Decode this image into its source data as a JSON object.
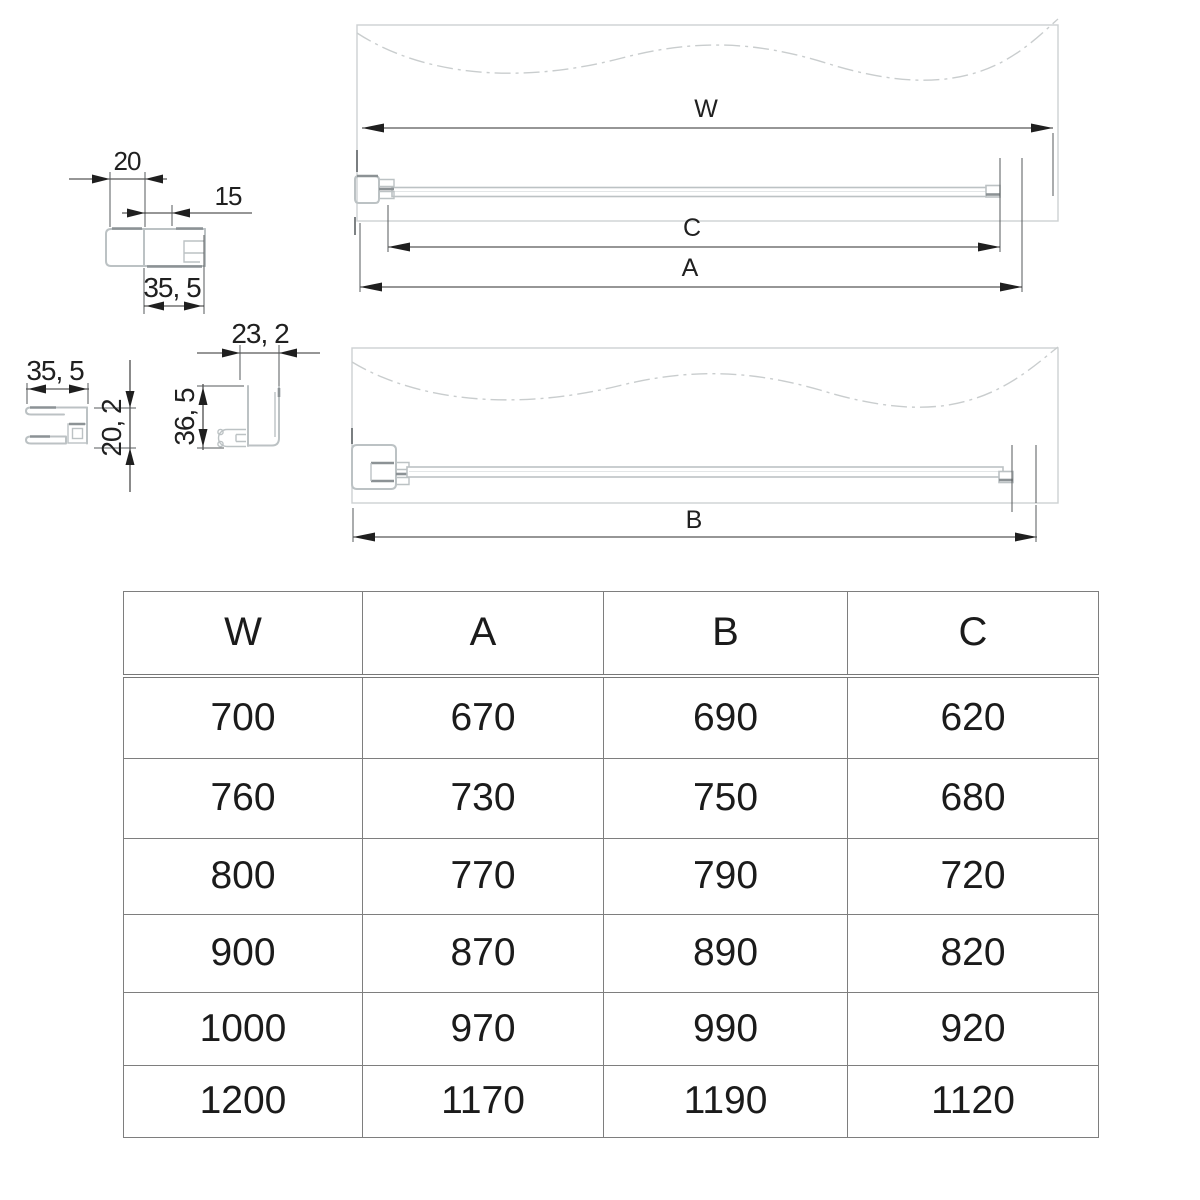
{
  "colors": {
    "profile_light": "#bcc2c4",
    "profile_dark": "#8c9295",
    "panel_outline": "#cdd1d2",
    "dimension_line": "#2c2c2c",
    "table_border": "#7e7e7e",
    "text": "#1b1b1b"
  },
  "profiles": {
    "p1": {
      "top_width": "20",
      "inset": "15",
      "base_width": "35, 5"
    },
    "p2": {
      "width": "35, 5",
      "height": "20, 2"
    },
    "p3": {
      "width": "23, 2",
      "height": "36, 5"
    }
  },
  "views": {
    "closed": {
      "w": "W",
      "c": "C",
      "a": "A"
    },
    "open": {
      "b": "B"
    }
  },
  "table": {
    "headers": [
      "W",
      "A",
      "B",
      "C"
    ],
    "rows": [
      [
        "700",
        "670",
        "690",
        "620"
      ],
      [
        "760",
        "730",
        "750",
        "680"
      ],
      [
        "800",
        "770",
        "790",
        "720"
      ],
      [
        "900",
        "870",
        "890",
        "820"
      ],
      [
        "1000",
        "970",
        "990",
        "920"
      ],
      [
        "1200",
        "1170",
        "1190",
        "1120"
      ]
    ]
  }
}
